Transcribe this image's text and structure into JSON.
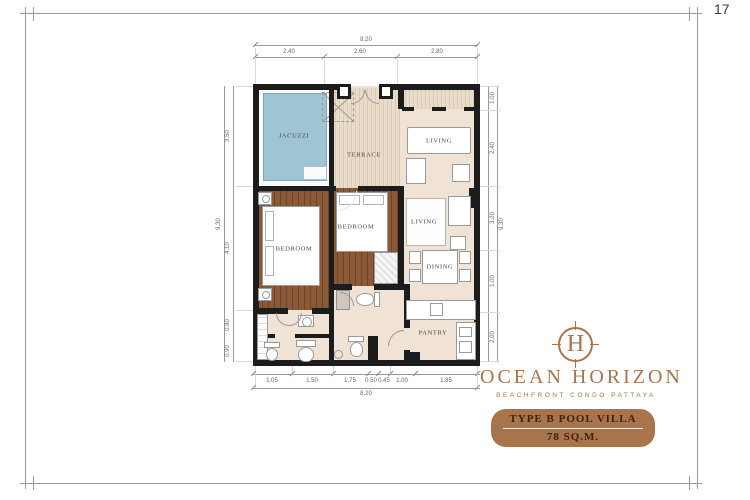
{
  "page": {
    "number": "17"
  },
  "floorplan": {
    "labels": {
      "jacuzzi": "JACUZZI",
      "terrace": "TERRACE",
      "living1": "LIVING",
      "living2": "LIVING",
      "dining": "DINING",
      "pantry": "PANTRY",
      "bedroom1": "BEDROOM",
      "bedroom2": "BEDROOM"
    },
    "dimensions": {
      "top_total": "8.20",
      "top_segments": [
        "2.40",
        "2.60",
        "2.80"
      ],
      "bottom_total": "8.20",
      "bottom_segments": [
        "1.05",
        "1.50",
        "1.75",
        "0.50",
        "0.45",
        "1.00",
        "1.85"
      ],
      "left_total": "9.30",
      "left_segments": [
        "3.50",
        "4.10",
        "0.80",
        "0.90"
      ],
      "right_total": "9.30",
      "right_segments": [
        "1.00",
        "2.40",
        "3.20",
        "1.00",
        "2.00"
      ]
    },
    "colors": {
      "pool": "#9FC5D5",
      "deck": "#E9DCCB",
      "floor": "#F1E2D6",
      "wood": "#8A5A38",
      "wall": "#1C1C1C"
    }
  },
  "brand": {
    "monogram": "H",
    "name": "OCEAN HORIZON",
    "tagline": "BEACHFRONT CONDO PATTAYA",
    "badge_title": "TYPE B POOL VILLA",
    "badge_area": "78 SQ.M.",
    "color": "#A9744B",
    "badge_text_color": "#3A2314"
  }
}
